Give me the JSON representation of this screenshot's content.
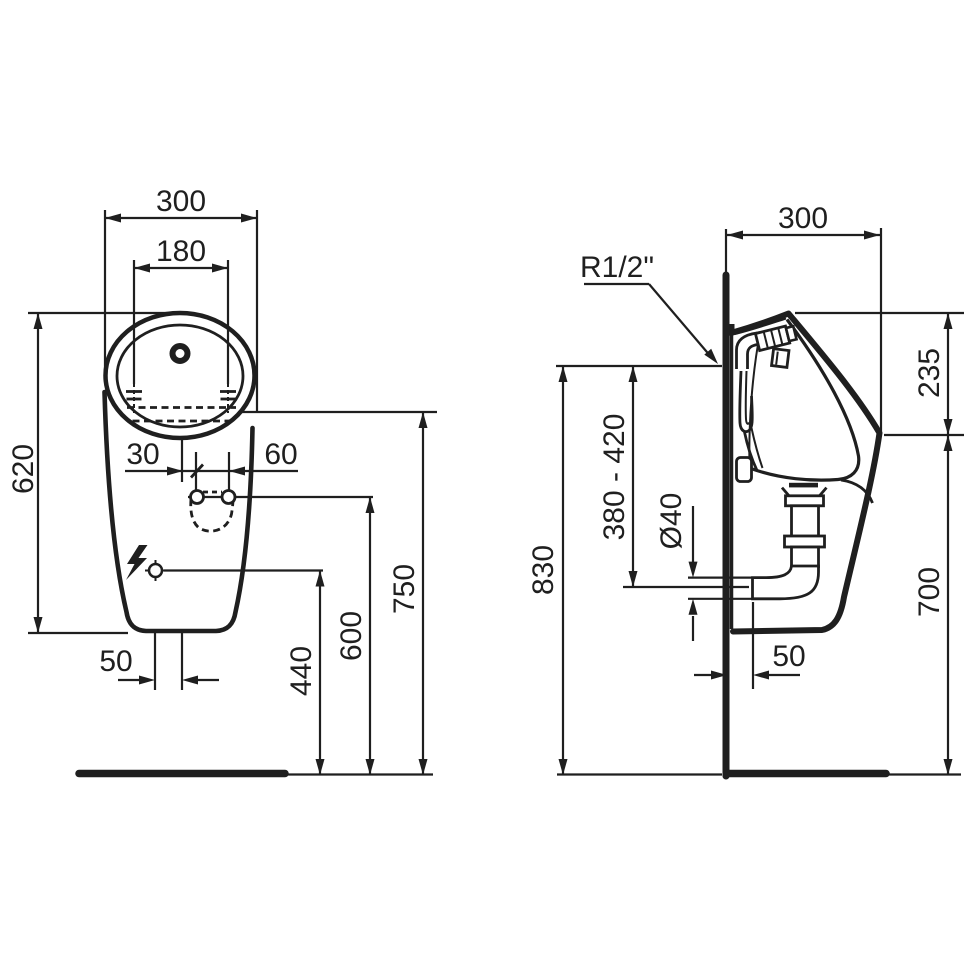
{
  "drawing": {
    "kind": "urinal installation dimension drawing",
    "background": "#ffffff",
    "line_color": "#1f1f1f"
  },
  "views": {
    "front": {
      "labels": {
        "overall_width": "300",
        "fixing_width": "180",
        "body_height": "620",
        "outlet_offset": "30",
        "fixing_hole_spacing": "60",
        "outlet_bottom_offset": "50",
        "sensor_height": "440",
        "fixing_hole_height": "600",
        "rim_height": "750"
      }
    },
    "side": {
      "labels": {
        "overall_depth": "300",
        "water_inlet_thread": "R1/2\"",
        "rim_drop": "235",
        "outlet_height_range": "380 - 420",
        "outlet_pipe_diameter": "Ø40",
        "inlet_height": "830",
        "front_edge_height": "700",
        "outlet_wall_offset": "50"
      }
    }
  }
}
